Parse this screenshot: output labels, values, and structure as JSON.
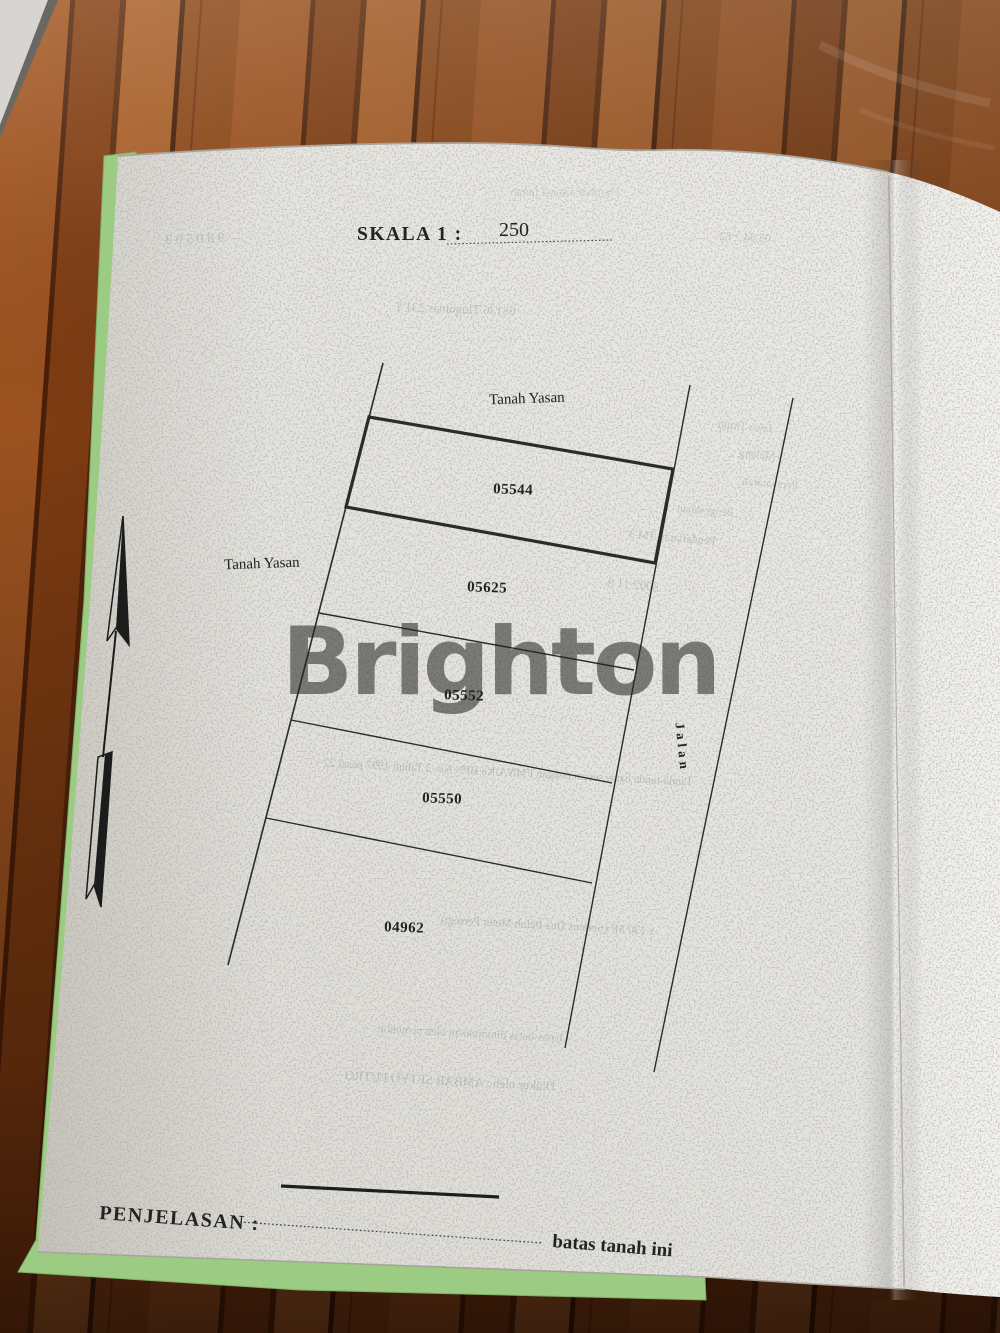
{
  "photo": {
    "watermark": "Brighton"
  },
  "document": {
    "scale": {
      "label": "SKALA 1 :",
      "value": "250"
    },
    "area_labels": {
      "top": "Tanah Yasan",
      "left": "Tanah Yasan"
    },
    "road_label": "Jalan",
    "parcels": [
      {
        "number": "05544",
        "emphasized": true
      },
      {
        "number": "05625",
        "emphasized": false
      },
      {
        "number": "05552",
        "emphasized": false
      },
      {
        "number": "05550",
        "emphasized": false
      },
      {
        "number": "04962",
        "emphasized": false
      }
    ],
    "legend": {
      "label": "PENJELASAN  :",
      "line_meaning": "batas tanah ini"
    }
  },
  "showthrough": [
    {
      "text": "Gambar situasi tanah"
    },
    {
      "text": "9 8   0 5   0 3"
    },
    {
      "text": "05 04 + 62"
    },
    {
      "text": "68136  Tlogomas  231  T"
    },
    {
      "text": "Jawa Timur"
    },
    {
      "text": "Malang"
    },
    {
      "text": "Persyaratan"
    },
    {
      "text": "Pengesahan"
    },
    {
      "text": "Pendaftaran TM 3"
    },
    {
      "text": "5002  11  8"
    },
    {
      "text": "Tanda-tanda batas sesuai dengan PMNA/Ka  BPN No. 3 Tahun 1997 pasal 22"
    },
    {
      "text": "± 130 M²  (Seratus Dua Puluh Meter Persegi)"
    },
    {
      "text": "batas-batas ditunjukkan oleh pemohon"
    },
    {
      "text": "Diukur oleh :  AMBAR SETYO PUTRO"
    }
  ],
  "colors": {
    "ink": "#2b2b2b",
    "paper_left": "#e4e3de",
    "paper_right": "#efeee9",
    "underlay_green": "#9ccb84",
    "watermark": "#ffffff"
  }
}
